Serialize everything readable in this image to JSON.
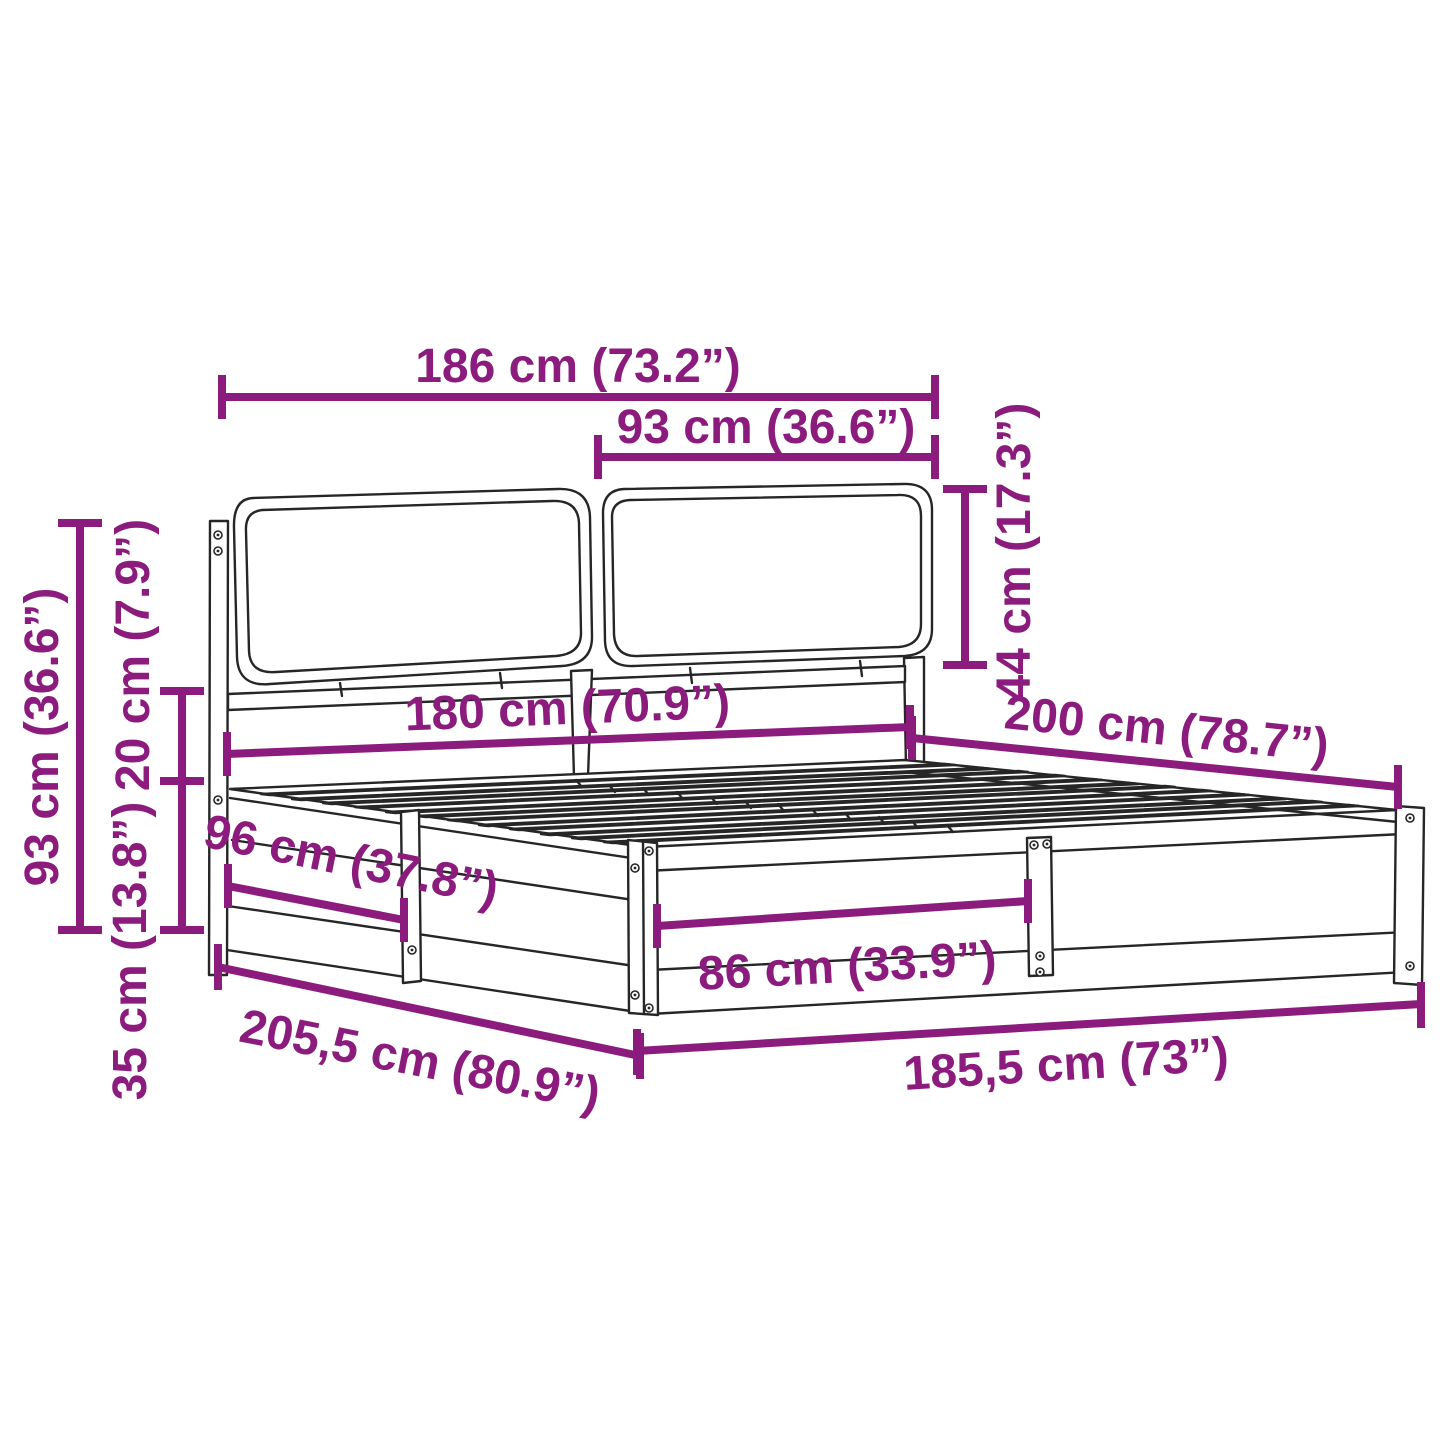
{
  "figure": {
    "background": "#ffffff",
    "line_color": "#262626",
    "dimension_color": "#8B1B7D"
  },
  "dimensions": {
    "headboard_width": {
      "label": "186 cm (73.2”)"
    },
    "cushion_width": {
      "label": "93 cm (36.6”)"
    },
    "cushion_height": {
      "label": "44 cm (17.3”)"
    },
    "total_height": {
      "label": "93 cm (36.6”)"
    },
    "headboard_clearance": {
      "label": "20 cm (7.9”)"
    },
    "base_height": {
      "label": "35 cm (13.8”)"
    },
    "side_bay_length": {
      "label": "96 cm (37.8”)"
    },
    "inner_width": {
      "label": "180 cm (70.9”)"
    },
    "inner_length": {
      "label": "200 cm (78.7”)"
    },
    "front_bay_width": {
      "label": "86 cm (33.9”)"
    },
    "outer_length": {
      "label": "205,5 cm (80.9”)"
    },
    "outer_width": {
      "label": "185,5 cm (73”)"
    }
  }
}
